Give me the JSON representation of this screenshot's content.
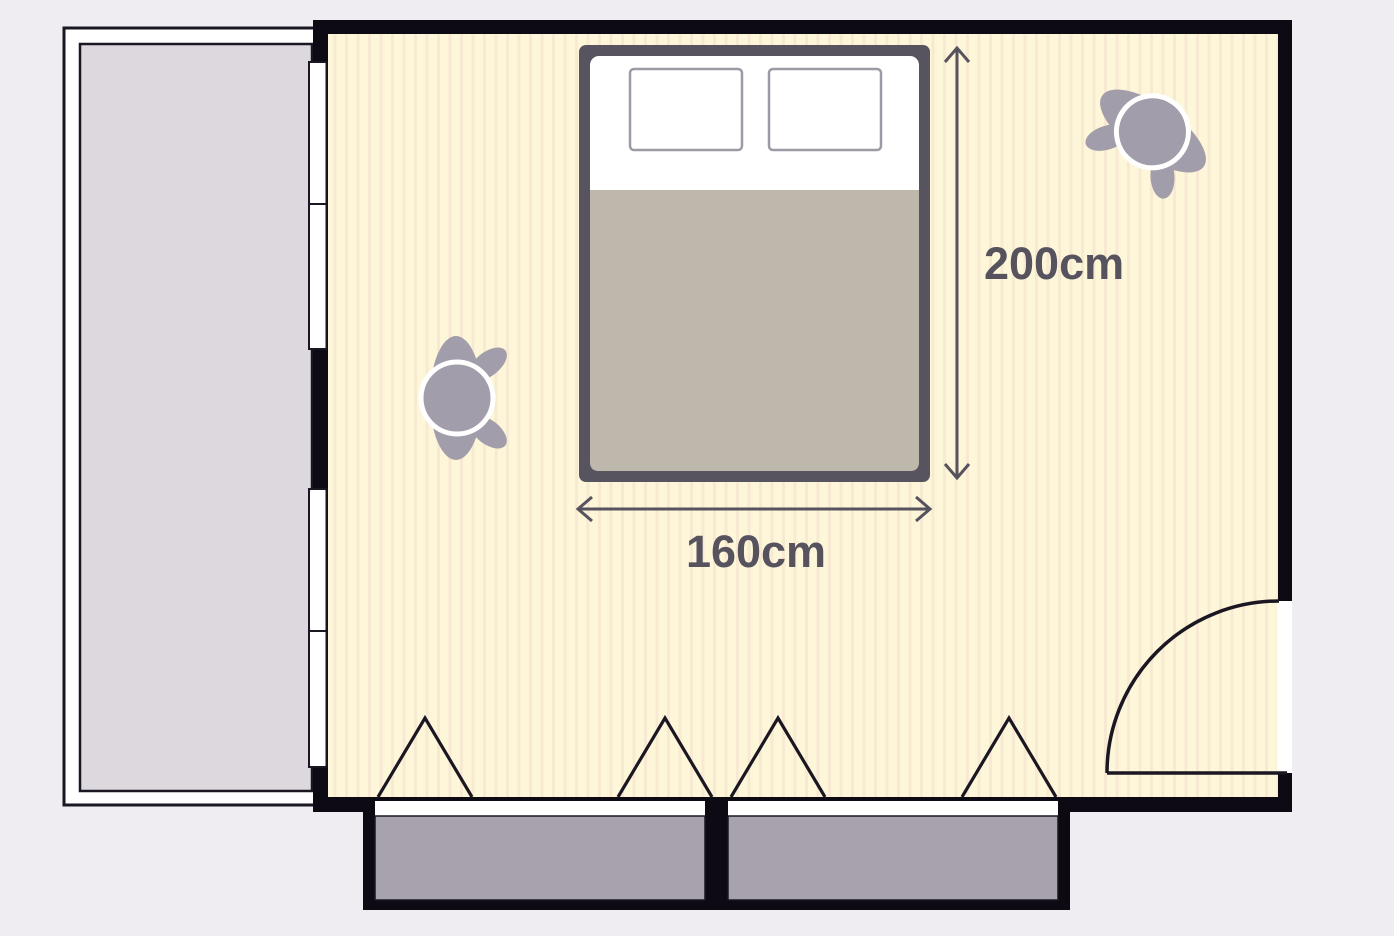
{
  "diagram": {
    "type": "floor-plan",
    "room": "bedroom-with-balcony",
    "dimension_labels": {
      "bed_length": "200cm",
      "bed_width": "160cm"
    },
    "furniture": [
      {
        "name": "double-bed",
        "width_label": "160cm",
        "length_label": "200cm",
        "pillows": 2
      },
      {
        "name": "wardrobe-left",
        "doors": 2
      },
      {
        "name": "wardrobe-right",
        "doors": 2
      }
    ],
    "features": [
      "balcony-left",
      "window-upper-left-wall",
      "window-lower-left-wall",
      "hinged-door-bottom-right",
      "person-center-facing-right",
      "person-top-right"
    ]
  },
  "colors": {
    "bg": "#efedf2",
    "wall": "#0d0a14",
    "line": "#1a1722",
    "floor-base": "#fdf6d9",
    "floor-stripe": "#f7e9d2",
    "balcony": "#dcd8dd",
    "bed-frame": "#58545f",
    "blanket": "#bdb7ac",
    "pillow-border": "#9e9aa5",
    "wardrobe": "#a7a2ab",
    "person": "#a29daa",
    "dim": "#56525e"
  }
}
